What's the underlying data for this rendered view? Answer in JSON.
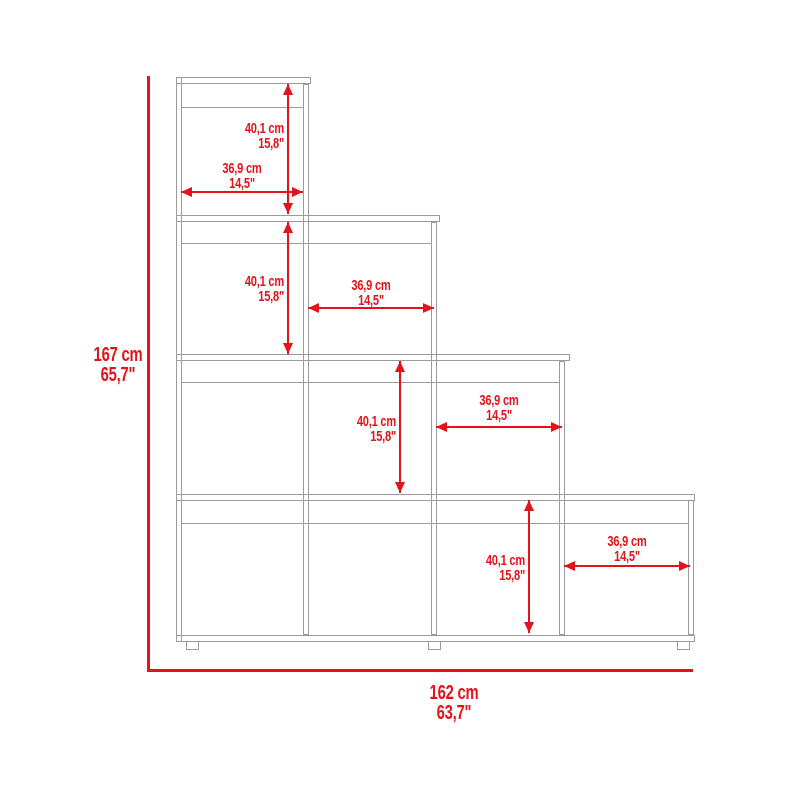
{
  "diagram": {
    "overall": {
      "height_cm": "167 cm",
      "height_in": "65,7\"",
      "width_cm": "162 cm",
      "width_in": "63,7\""
    },
    "tiers": [
      {
        "height_cm": "40,1 cm",
        "height_in": "15,8\"",
        "width_cm": "36,9 cm",
        "width_in": "14,5\""
      },
      {
        "height_cm": "40,1 cm",
        "height_in": "15,8\"",
        "width_cm": "36,9 cm",
        "width_in": "14,5\""
      },
      {
        "height_cm": "40,1 cm",
        "height_in": "15,8\"",
        "width_cm": "36,9 cm",
        "width_in": "14,5\""
      },
      {
        "height_cm": "40,1 cm",
        "height_in": "15,8\"",
        "width_cm": "36,9 cm",
        "width_in": "14,5\""
      }
    ],
    "colors": {
      "dimension_red": "#e3131b",
      "outline_gray": "#9b9b9b",
      "background": "#ffffff"
    }
  }
}
